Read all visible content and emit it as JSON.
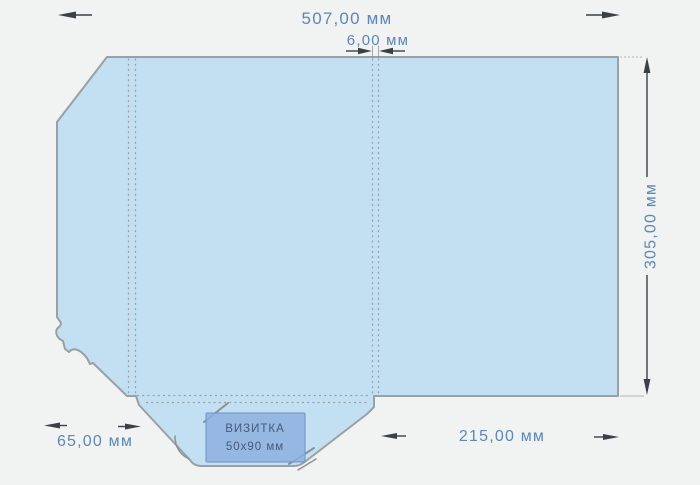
{
  "drawing": {
    "dimensions": {
      "width": "507,00 мм",
      "spine": "6,00 мм",
      "height": "305,00 мм",
      "flap": "65,00 мм",
      "panel": "215,00 мм"
    },
    "business_card": {
      "title": "ВИЗИТКА",
      "size": "50x90 мм"
    },
    "colors": {
      "background": "#f1f2f2",
      "shape_fill": "#c3dff2",
      "shape_outline": "#9aa0a5",
      "fold_line": "#98a1a9",
      "dimension_text": "#5d87b5",
      "arrow": "#3a4047",
      "card_fill": "#8db0de",
      "card_text": "#475a7b"
    }
  }
}
